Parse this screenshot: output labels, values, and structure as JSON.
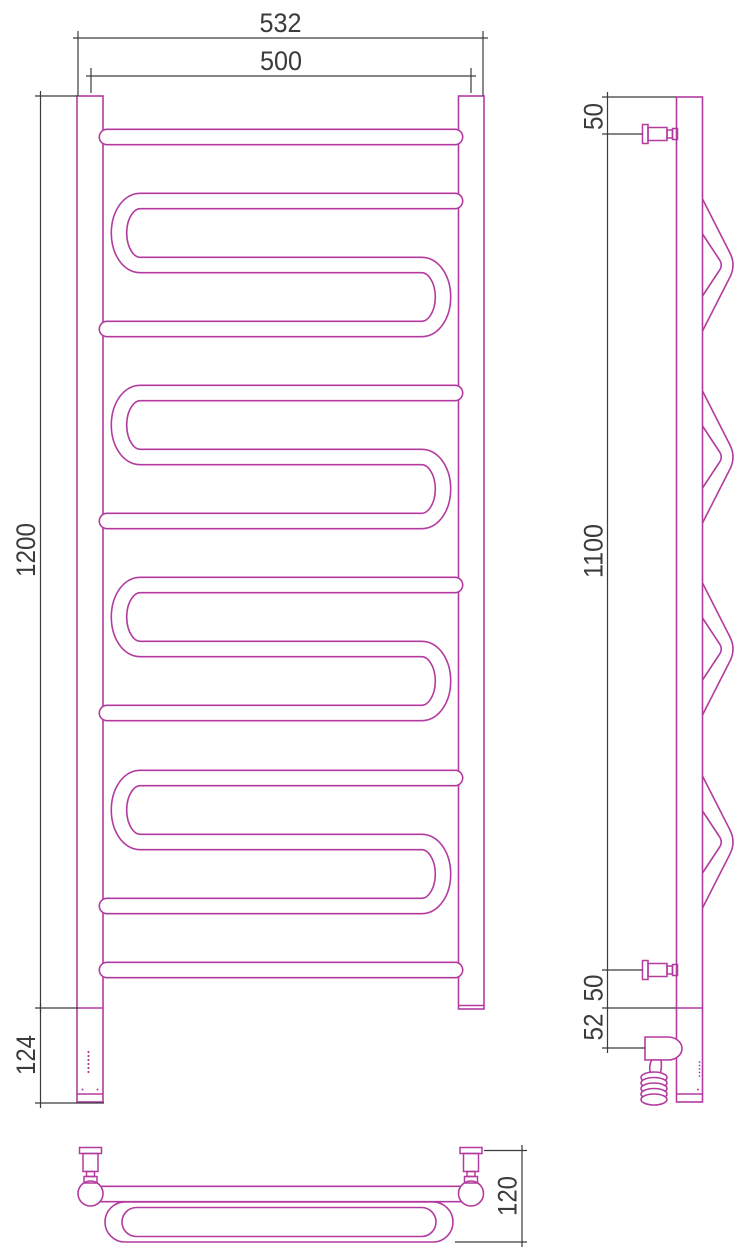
{
  "dims": {
    "front_overall_width": "532",
    "front_axis_width": "500",
    "front_height": "1200",
    "front_lower_section": "124",
    "side_top_offset": "50",
    "side_bracket_span": "1100",
    "side_bottom_offset": "50",
    "side_heater_offset": "52",
    "top_depth": "120"
  },
  "colors": {
    "product_outline": "#b33b9f",
    "dimension": "#3b3b3b",
    "background": "#ffffff"
  }
}
